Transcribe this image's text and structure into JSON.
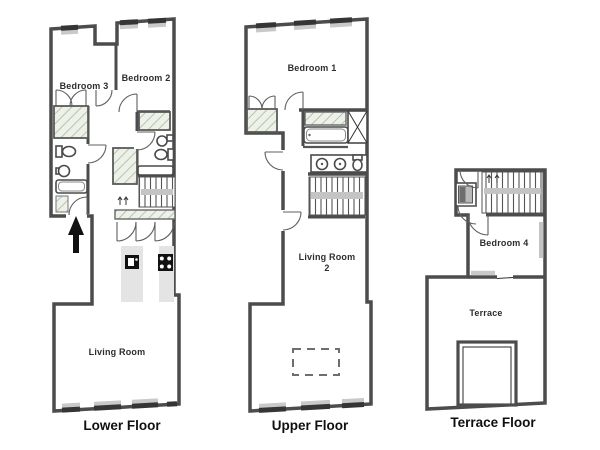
{
  "image": {
    "type": "apartment-floor-plan-set",
    "background": "#ffffff"
  },
  "colors": {
    "wall": "#4c4c4c",
    "window_bar": "#353535",
    "window_sill": "#c9c9c9",
    "kitchen_counter": "#e4e4e4",
    "stair_rail": "#c4c4c4",
    "closet_hatch_fill": "#edf1e8",
    "closet_hatch_line": "#a9b8a4",
    "room_label_text": "#2d2d2d",
    "caption_text": "#101010"
  },
  "floors": [
    {
      "caption": "Lower Floor",
      "rooms": {
        "bedroom3": "Bedroom 3",
        "bedroom2": "Bedroom 2",
        "living_room": "Living Room"
      },
      "features": [
        "entrance-arrow",
        "bathroom",
        "bathroom-2",
        "closets",
        "stairs",
        "kitchen",
        "windows"
      ]
    },
    {
      "caption": "Upper Floor",
      "rooms": {
        "bedroom1": "Bedroom 1",
        "living_room2_line1": "Living Room",
        "living_room2_line2": "2"
      },
      "features": [
        "bathroom-double-sink",
        "bathtub",
        "shaft",
        "stairs",
        "closets",
        "dashed-table",
        "windows"
      ]
    },
    {
      "caption": "Terrace Floor",
      "rooms": {
        "bedroom4": "Bedroom 4",
        "terrace": "Terrace"
      },
      "features": [
        "stairs",
        "closet",
        "wardrobe",
        "terrace-opening"
      ]
    }
  ]
}
